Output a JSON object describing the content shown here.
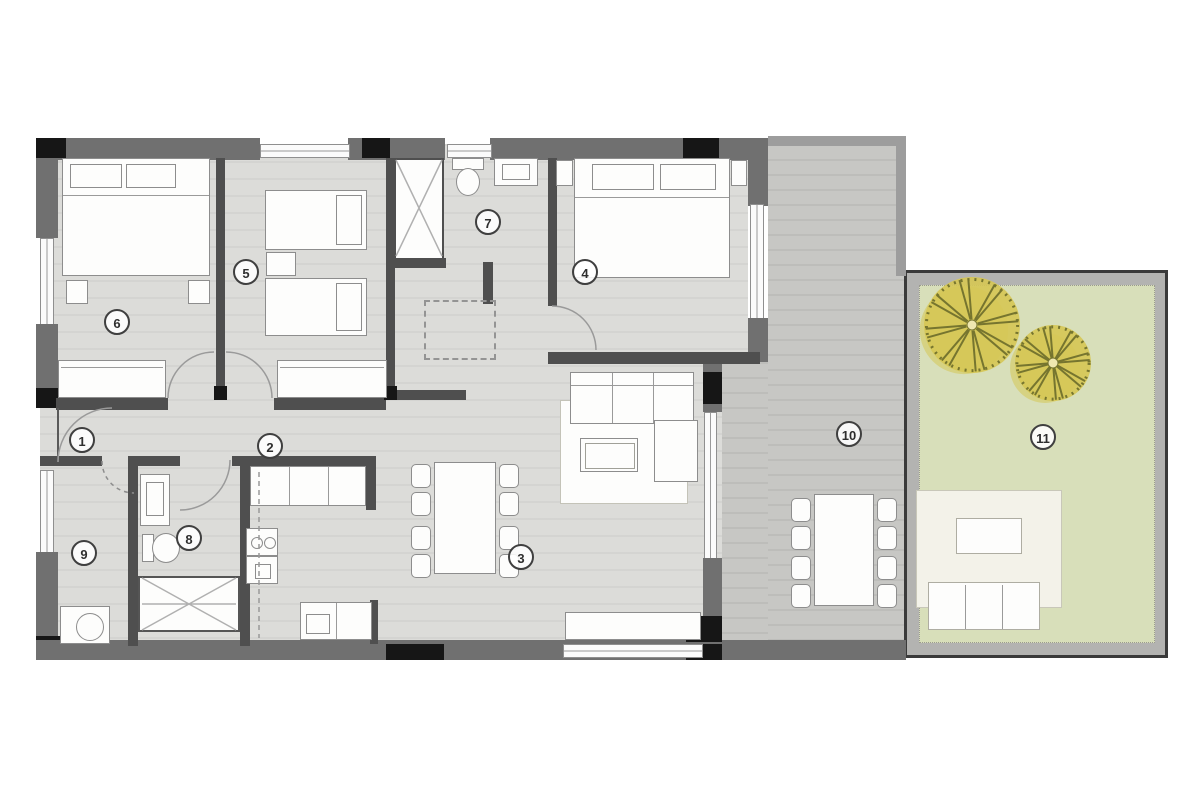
{
  "plan": {
    "room_markers": [
      {
        "number": "1",
        "x": 82,
        "y": 440
      },
      {
        "number": "2",
        "x": 270,
        "y": 446
      },
      {
        "number": "3",
        "x": 521,
        "y": 557
      },
      {
        "number": "4",
        "x": 585,
        "y": 272
      },
      {
        "number": "5",
        "x": 246,
        "y": 272
      },
      {
        "number": "6",
        "x": 117,
        "y": 322
      },
      {
        "number": "7",
        "x": 488,
        "y": 222
      },
      {
        "number": "8",
        "x": 189,
        "y": 538
      },
      {
        "number": "9",
        "x": 84,
        "y": 553
      },
      {
        "number": "10",
        "x": 849,
        "y": 434
      },
      {
        "number": "11",
        "x": 1043,
        "y": 437
      }
    ],
    "trees": [
      {
        "x": 972,
        "y": 325,
        "r": 48
      },
      {
        "x": 1053,
        "y": 363,
        "r": 38
      }
    ],
    "colors": {
      "wall": "#707070",
      "iwall": "#4f4f4f",
      "column": "#161616",
      "floor": "#dcdcd9",
      "deck": "#c7c7c4",
      "garden": "#d8dfba",
      "gardenFrame": "#3a3a3a",
      "gardenBand": "#b3b3b1",
      "lounge": "#f3f2e9",
      "furniture": "#fdfdfc",
      "furnBorder": "#8d8d8d",
      "tree": "#d6c654",
      "treeDark": "#76752f",
      "marker": "#3f3f3f"
    }
  }
}
